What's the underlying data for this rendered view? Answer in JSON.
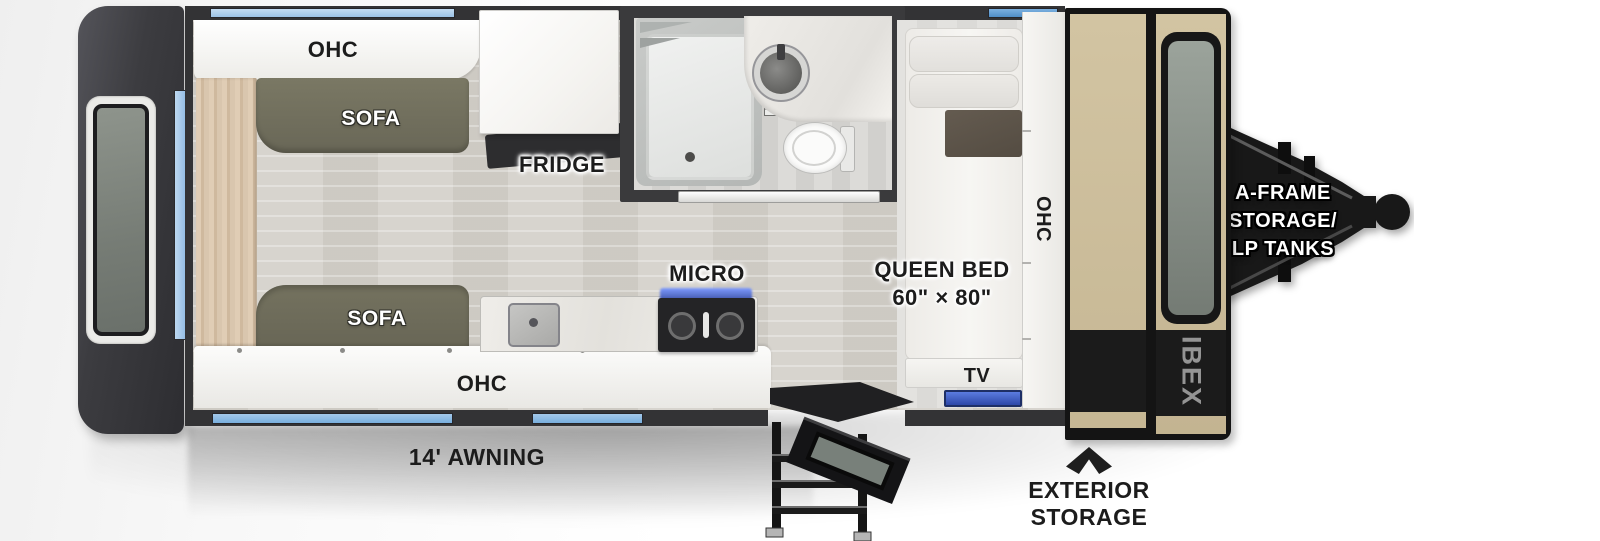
{
  "diagram": {
    "type": "rv-travel-trailer-floorplan",
    "labels": {
      "ohc_top": "OHC",
      "sofa_top": "SOFA",
      "sofa_bottom": "SOFA",
      "fridge": "FRIDGE",
      "micro": "MICRO",
      "ohc_bottom": "OHC",
      "ohc_front": "OHC",
      "queen_bed": "QUEEN BED",
      "queen_bed_size": "60\" × 80\"",
      "tv": "TV",
      "awning": "14' AWNING",
      "exterior_storage": [
        "EXTERIOR",
        "STORAGE"
      ],
      "aframe_storage": [
        "A-FRAME",
        "STORAGE/",
        "LP TANKS"
      ],
      "front_logo": "IBEX"
    },
    "colors": {
      "wall": "#333335",
      "window_blue_light": "#aacbe9",
      "window_blue": "#85b8e6",
      "window_blue_mid": "#5e9ed6",
      "sofa_olive": "#6f6e5c",
      "wood_panel": "#d9c6ae",
      "front_cap_tan": "#cbbd9b",
      "tv_blue": "#3a5fd0",
      "label_black": "#1c1c1c"
    }
  }
}
